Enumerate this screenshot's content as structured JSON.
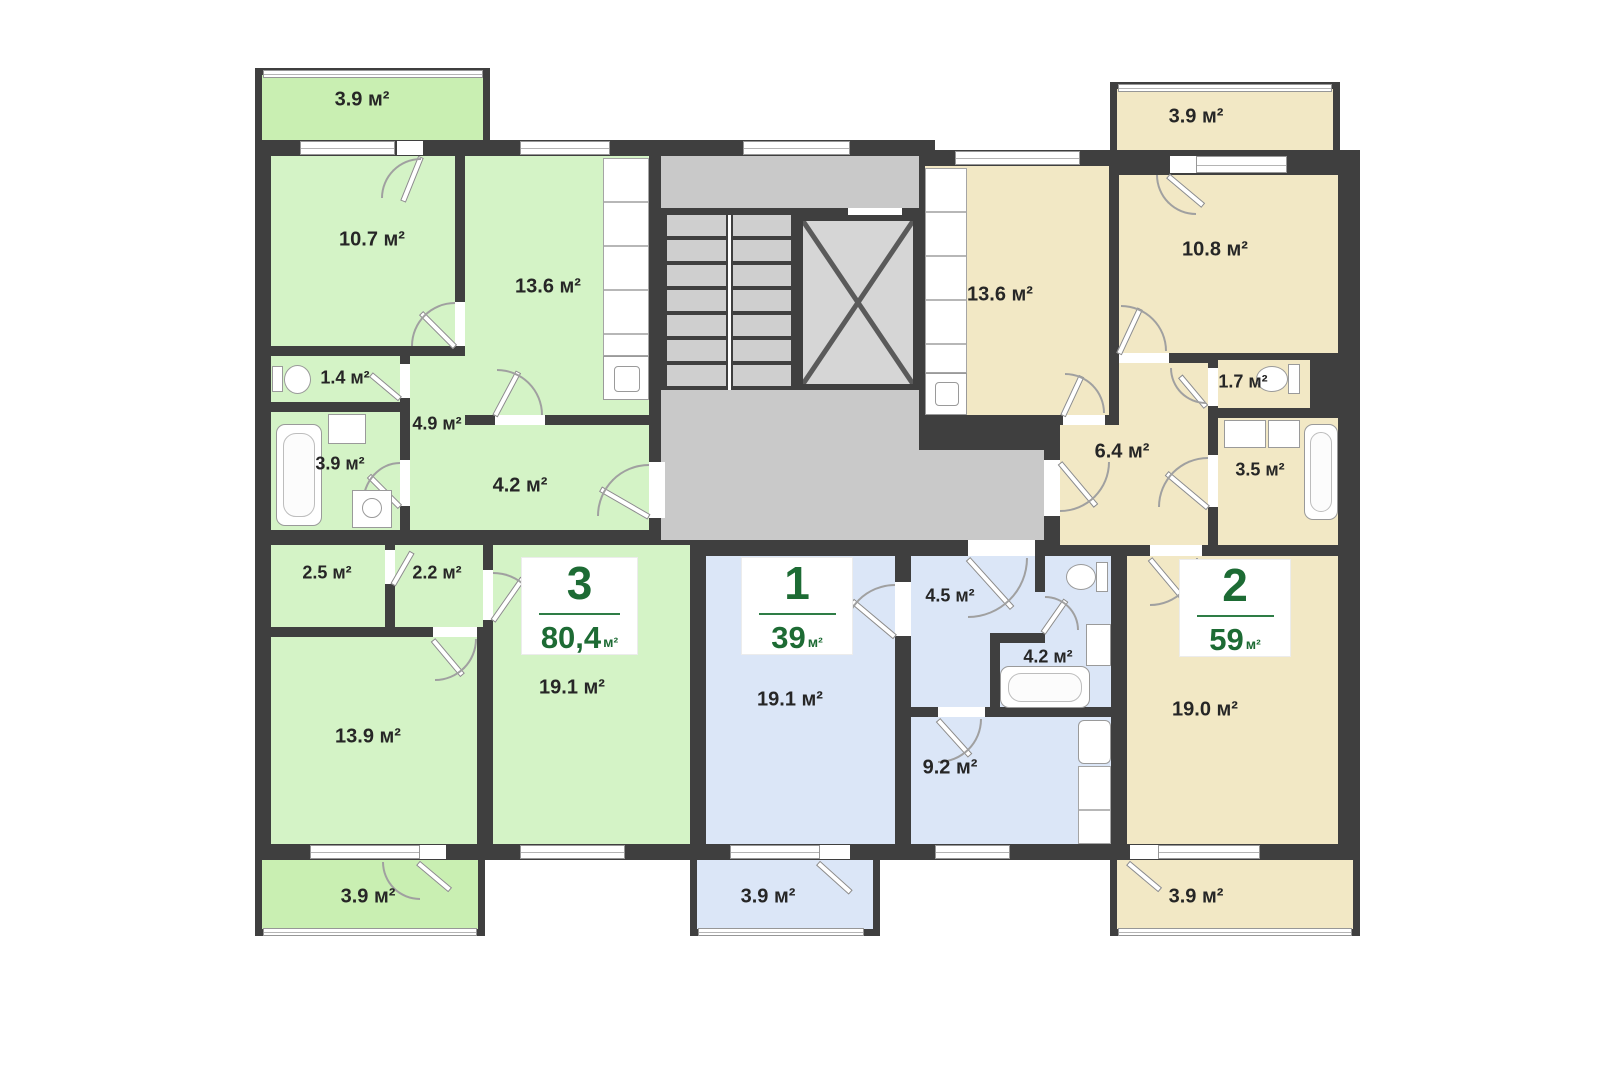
{
  "title": "apartment-floor-plan",
  "unit": "м²",
  "colors": {
    "wall": "#3f3f3f",
    "apartment_3_green": "#d4f3c6",
    "green_balcony": "#c9efb2",
    "apartment_1_blue": "#dbe6f7",
    "apartment_2_beige": "#f2e8c5",
    "common_area_gray": "#c9c9c9",
    "badge_text_green": "#1d6b34",
    "room_label_text": "#262626"
  },
  "apartments": [
    {
      "key": "apartment-3",
      "number": "3",
      "total_area": "80,4",
      "unit": "м²",
      "color": "#d4f3c6",
      "rooms": [
        {
          "name": "balcony-top",
          "label": "3.9 м²"
        },
        {
          "name": "bedroom",
          "label": "10.7 м²"
        },
        {
          "name": "kitchen",
          "label": "13.6 м²"
        },
        {
          "name": "wc",
          "label": "1.4 м²"
        },
        {
          "name": "hall",
          "label": "4.9 м²"
        },
        {
          "name": "bathroom",
          "label": "3.9 м²"
        },
        {
          "name": "corridor",
          "label": "4.2 м²"
        },
        {
          "name": "storage",
          "label": "2.5 м²"
        },
        {
          "name": "hallway",
          "label": "2.2 м²"
        },
        {
          "name": "living-room",
          "label": "19.1 м²"
        },
        {
          "name": "bedroom-2",
          "label": "13.9 м²"
        },
        {
          "name": "balcony-bottom",
          "label": "3.9 м²"
        }
      ]
    },
    {
      "key": "apartment-1",
      "number": "1",
      "total_area": "39",
      "unit": "м²",
      "color": "#dbe6f7",
      "rooms": [
        {
          "name": "living-room",
          "label": "19.1 м²"
        },
        {
          "name": "hall",
          "label": "4.5 м²"
        },
        {
          "name": "bathroom",
          "label": "4.2 м²"
        },
        {
          "name": "kitchen",
          "label": "9.2 м²"
        },
        {
          "name": "balcony",
          "label": "3.9 м²"
        }
      ]
    },
    {
      "key": "apartment-2",
      "number": "2",
      "total_area": "59",
      "unit": "м²",
      "color": "#f2e8c5",
      "rooms": [
        {
          "name": "balcony-top",
          "label": "3.9 м²"
        },
        {
          "name": "bedroom",
          "label": "10.8 м²"
        },
        {
          "name": "kitchen",
          "label": "13.6 м²"
        },
        {
          "name": "wc",
          "label": "1.7 м²"
        },
        {
          "name": "hall",
          "label": "6.4 м²"
        },
        {
          "name": "bathroom",
          "label": "3.5 м²"
        },
        {
          "name": "living-room",
          "label": "19.0 м²"
        },
        {
          "name": "balcony-bottom",
          "label": "3.9 м²"
        }
      ]
    }
  ]
}
